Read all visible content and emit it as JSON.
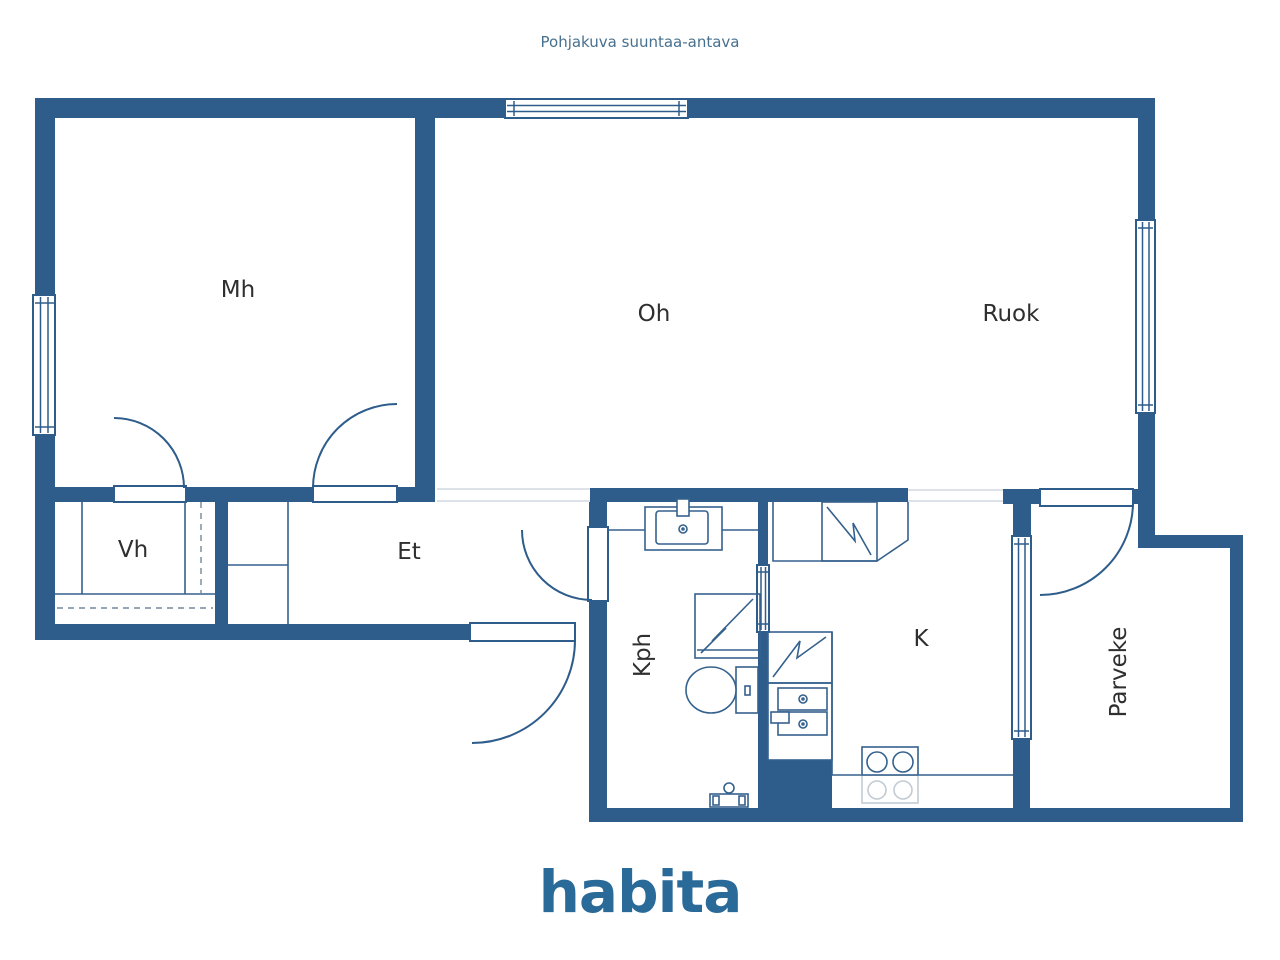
{
  "header": {
    "disclaimer": "Pohjakuva suuntaa-antava"
  },
  "brand": {
    "logo_text": "habita"
  },
  "floor_plan": {
    "rooms": [
      {
        "id": "mh",
        "label": "Mh"
      },
      {
        "id": "oh",
        "label": "Oh"
      },
      {
        "id": "ruok",
        "label": "Ruok"
      },
      {
        "id": "vh",
        "label": "Vh"
      },
      {
        "id": "et",
        "label": "Et"
      },
      {
        "id": "kph",
        "label": "Kph"
      },
      {
        "id": "k",
        "label": "K"
      },
      {
        "id": "parveke",
        "label": "Parveke"
      }
    ]
  },
  "colors": {
    "wall": "#2e5d8b",
    "fixture_stroke": "#35618d",
    "fixture_light": "#c2cbd3",
    "threshold": "#dce2e8",
    "label_text": "#2f2f2f",
    "header_text": "#47708f",
    "logo": "#2a6a99",
    "background": "#ffffff"
  }
}
